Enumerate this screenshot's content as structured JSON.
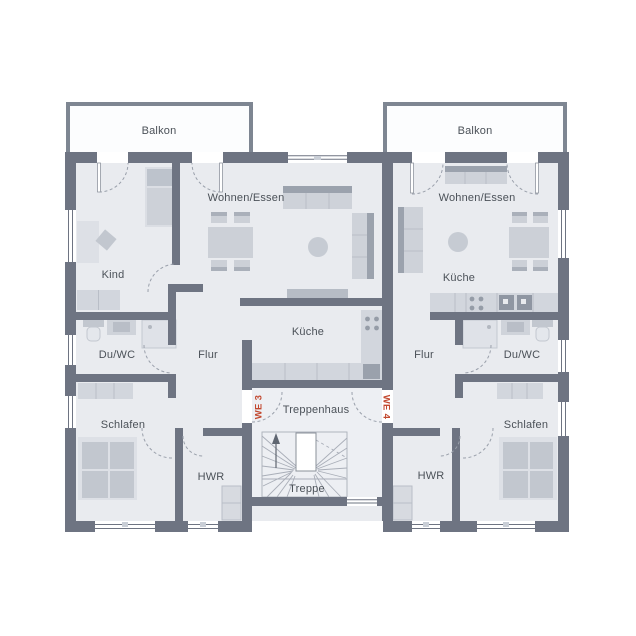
{
  "plan_type": "floor-plan",
  "units": [
    {
      "id": "we3",
      "label": "WE 3"
    },
    {
      "id": "we4",
      "label": "WE 4"
    }
  ],
  "rooms": {
    "balkon_left": "Balkon",
    "balkon_right": "Balkon",
    "wohnen_essen_left": "Wohnen/Essen",
    "wohnen_essen_right": "Wohnen/Essen",
    "kind": "Kind",
    "kueche_left": "Küche",
    "kueche_right": "Küche",
    "du_wc_left": "Du/WC",
    "du_wc_right": "Du/WC",
    "flur_left": "Flur",
    "flur_right": "Flur",
    "schlafen_left": "Schlafen",
    "schlafen_right": "Schlafen",
    "hwr_left": "HWR",
    "hwr_right": "HWR",
    "treppenhaus": "Treppenhaus",
    "treppe": "Treppe"
  },
  "colors": {
    "wall": "#6e7482",
    "floor": "#e9ebef",
    "stairwell_floor": "#edeff3",
    "furniture": "#d2d6dd",
    "furniture_dark": "#9ba2ad",
    "balcony_border": "#7e8692",
    "label_text": "#4b5158",
    "unit_label_accent": "#c2472e"
  }
}
